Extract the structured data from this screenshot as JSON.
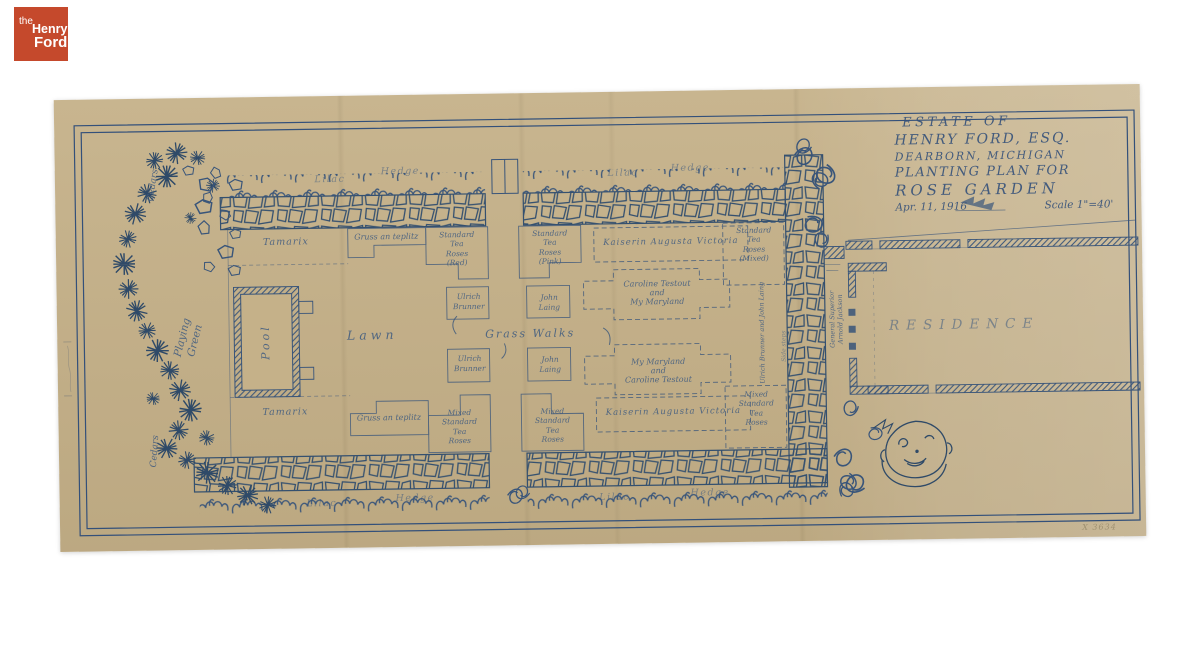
{
  "logo": {
    "word_the": "the",
    "word_henry": "Henry",
    "word_ford": "Ford",
    "bg_color": "#c5492c"
  },
  "title_block": {
    "line1": "ESTATE OF",
    "line2": "HENRY FORD, ESQ.",
    "line3": "DEARBORN, MICHIGAN",
    "line4": "PLANTING PLAN FOR",
    "line5": "ROSE GARDEN",
    "date": "Apr. 11, 1916",
    "scale": "Scale 1\"=40'"
  },
  "plan": {
    "areas": {
      "cedars_top": "Cedars",
      "cedars_bottom": "Cedars",
      "playing_green": "Playing\nGreen",
      "pool": "Pool",
      "tamarix_top": "Tamarix",
      "tamarix_bottom": "Tamarix",
      "lawn": "Lawn",
      "grass_walks": "Grass Walks",
      "residence": "RESIDENCE",
      "climbing_roses": "Ulrich Brunner and John Laing",
      "wall_note": "Side steps",
      "porch_note": "General Superior\nArnold Jackson"
    },
    "hedges": {
      "top_left_lilac": "Lilac",
      "top_left_hedge": "Hedge",
      "top_right_lilac": "Lilac",
      "top_right_hedge": "Hedge",
      "bottom_left_lilac": "Lilac",
      "bottom_left_hedge": "Hedge",
      "bottom_right_lilac": "Lilac",
      "bottom_right_hedge": "Hedge"
    },
    "beds": {
      "gruss_top": "Gruss an teplitz",
      "standard_red": "Standard\nTea\nRoses\n(Red)",
      "standard_pink": "Standard\nTea\nRoses\n(Pink)",
      "kaiserin_top": "Kaiserin Augusta Victoria",
      "standard_mixed": "Standard\nTea\nRoses\n(Mixed)",
      "ulrich_upper": "Ulrich\nBrunner",
      "john_upper": "John\nLaing",
      "testout_upper": "Caroline Testout\nand\nMy Maryland",
      "ulrich_lower": "Ulrich\nBrunner",
      "john_lower": "John\nLaing",
      "testout_lower": "My Maryland\nand\nCaroline Testout",
      "gruss_bottom": "Gruss an teplitz",
      "mixed_a": "Mixed\nStandard\nTea\nRoses",
      "mixed_b": "Mixed\nStandard\nTea\nRoses",
      "kaiserin_bottom": "Kaiserin Augusta Victoria",
      "mixed_right": "Mixed\nStandard\nTea\nRoses"
    }
  },
  "annotations": {
    "catalog_number": "X 3634"
  },
  "colors": {
    "paper": "#c5b189",
    "ink": "#39557a",
    "logo_red": "#c5492c",
    "background": "#ffffff"
  }
}
